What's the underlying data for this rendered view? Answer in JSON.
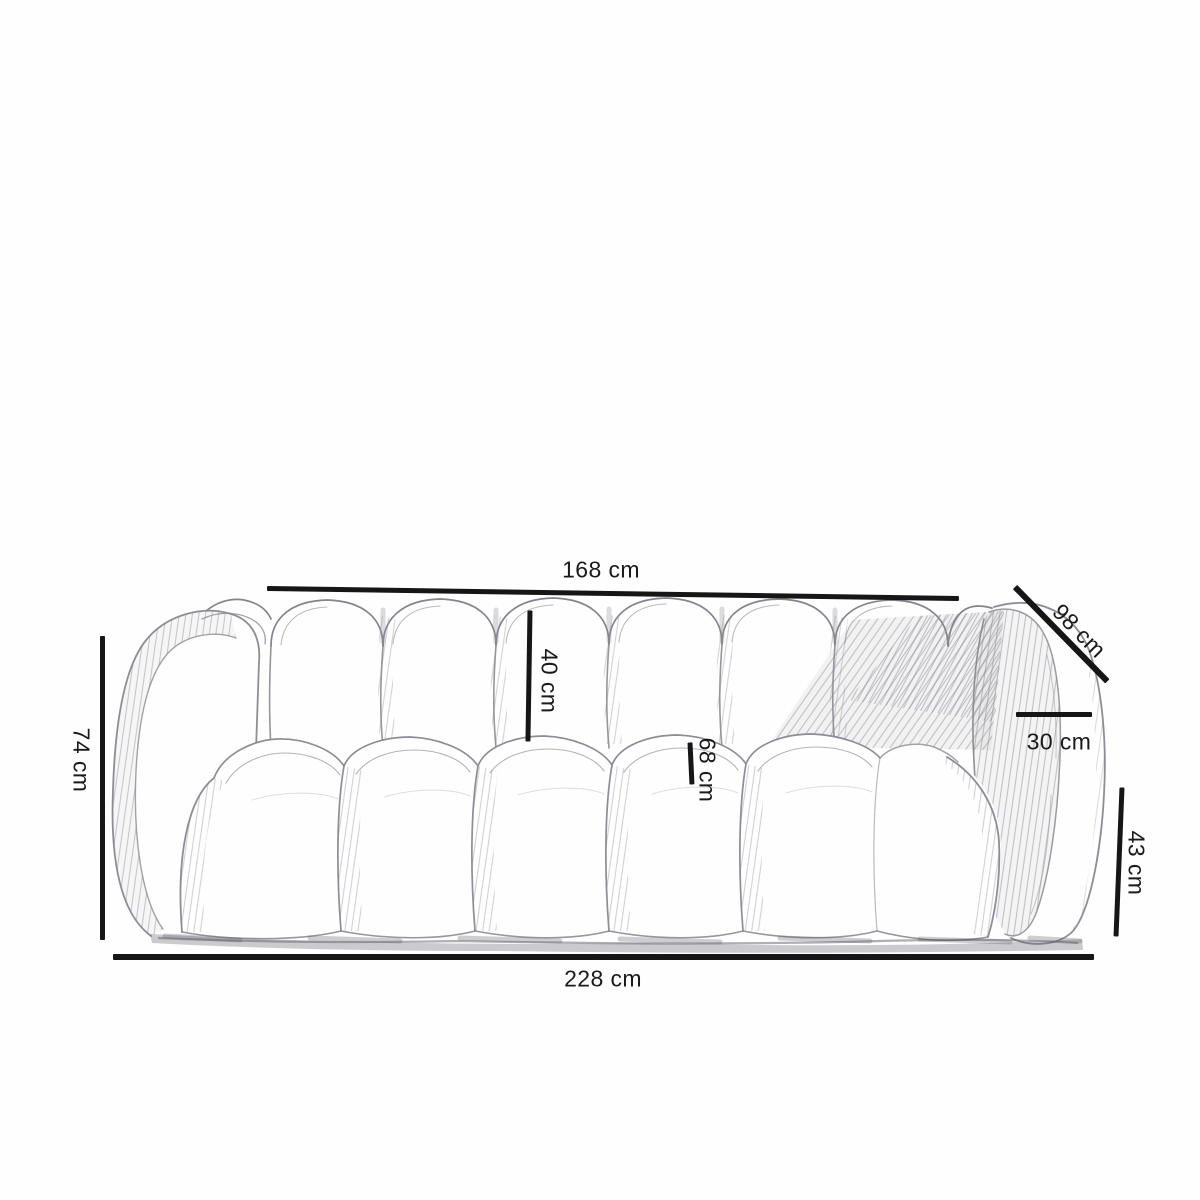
{
  "diagram": {
    "subject": "sofa-dimension-sketch",
    "unit": "cm",
    "measurements": {
      "seat_width": {
        "label": "168 cm",
        "value": 168
      },
      "diagonal_depth": {
        "label": "98 cm",
        "value": 98
      },
      "armrest_top_width": {
        "label": "30 cm",
        "value": 30
      },
      "armrest_side_height": {
        "label": "43 cm",
        "value": 43
      },
      "overall_width": {
        "label": "228 cm",
        "value": 228
      },
      "overall_height": {
        "label": "74 cm",
        "value": 74
      },
      "backrest_cushion_height": {
        "label": "40 cm",
        "value": 40
      },
      "seat_cushion_height": {
        "label": "68 cm",
        "value": 68
      }
    }
  }
}
